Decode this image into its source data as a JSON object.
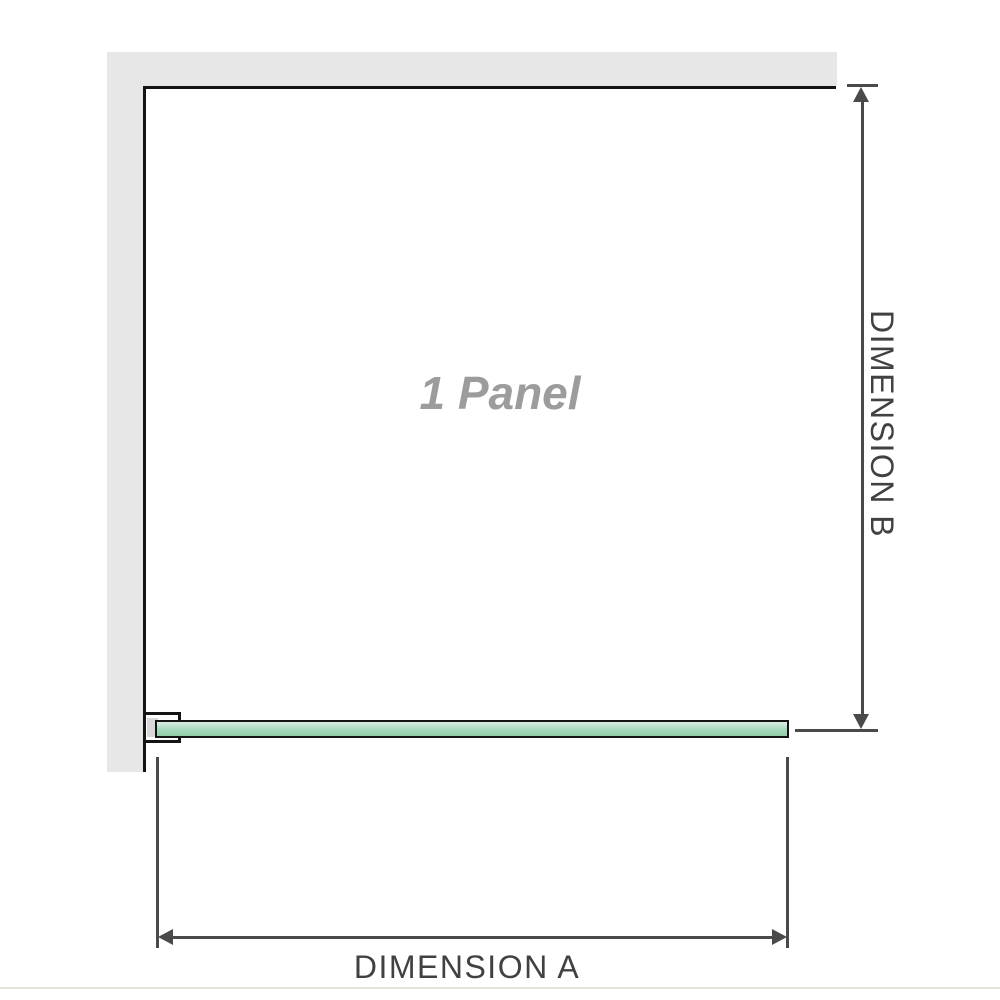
{
  "diagram": {
    "watermark": "1 Panel",
    "dimension_a_label": "DIMENSION A",
    "dimension_b_label": "DIMENSION B"
  },
  "colors": {
    "background": "#ffffff",
    "wall": "#e7e7e7",
    "structure-line": "#141414",
    "dimension-line": "#4a4a4a",
    "glass-light": "#d9eee2",
    "glass-mid": "#a6d8ba",
    "glass-dark": "#90cea7",
    "label": "#414141",
    "watermark": "#9c9c9c",
    "divider": "#e6e4de"
  }
}
